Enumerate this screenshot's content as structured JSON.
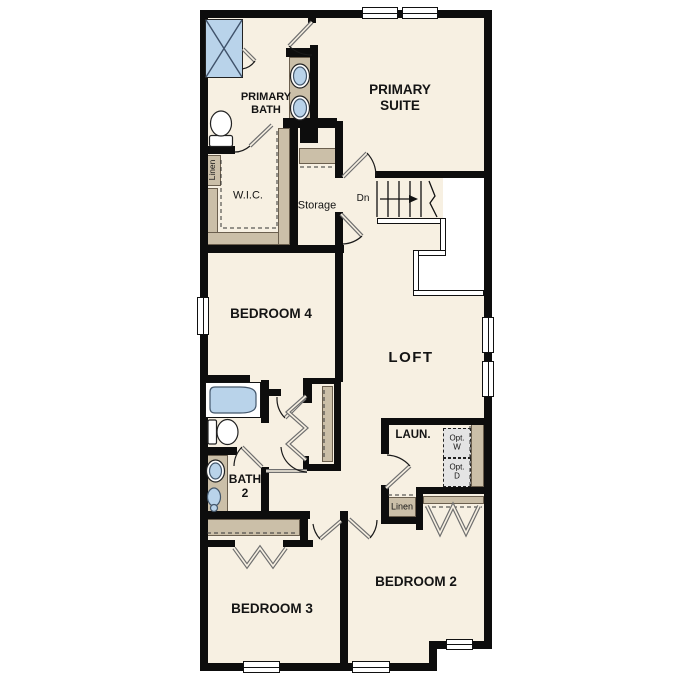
{
  "rooms": {
    "primary_suite": "PRIMARY SUITE",
    "primary_bath": "PRIMARY BATH",
    "wic": "W.I.C.",
    "storage": "Storage",
    "bedroom4": "BEDROOM 4",
    "loft": "LOFT",
    "bath2": "BATH 2",
    "laundry": "LAUN.",
    "bedroom3": "BEDROOM 3",
    "bedroom2": "BEDROOM 2"
  },
  "labels": {
    "stairs_down": "Dn",
    "linen_wic": "Linen",
    "linen_hall": "Linen",
    "opt_washer": "Opt. W",
    "opt_dryer": "Opt. D"
  },
  "colors": {
    "floor": "#f7f0e2",
    "wall": "#0d0d0d",
    "casework": "#cbbfa8",
    "fixture_blue": "#b9d3ea",
    "door_swing": "#6f6f6f"
  }
}
